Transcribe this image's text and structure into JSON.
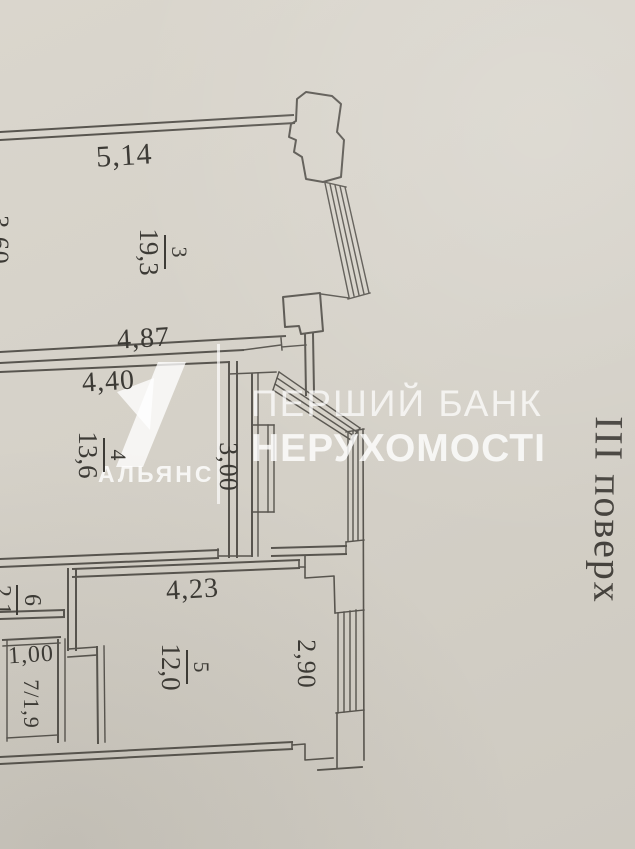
{
  "document": {
    "kind": "apartment floor plan photo"
  },
  "watermarks": {
    "alliance": {
      "name": "АЛЬЯНС"
    },
    "bank": {
      "line1": "ПЕРШИЙ БАНК",
      "line2": "НЕРУХОМОСТІ"
    }
  },
  "floor_label": "ІІІ поверх",
  "dimensions": {
    "room3_top": "5,14",
    "room3_left": "3,60",
    "room3_bottom": "4,87",
    "room4_top": "4,40",
    "loggia_depth": "3,00",
    "room5_top": "4,23",
    "room5_right": "2,90",
    "room7_top": "1,00"
  },
  "rooms": {
    "r3": {
      "number": "3",
      "area": "19,3"
    },
    "r4": {
      "number": "4",
      "area": "13,6"
    },
    "r5": {
      "number": "5",
      "area": "12,0"
    },
    "r6": {
      "number": "6",
      "area": "2,1"
    },
    "r7": {
      "label": "7/1,9"
    }
  },
  "colors": {
    "paper": "#d5d1c8",
    "line": "#4e4b45",
    "text": "#3c3a35",
    "watermark": "#ffffff"
  }
}
